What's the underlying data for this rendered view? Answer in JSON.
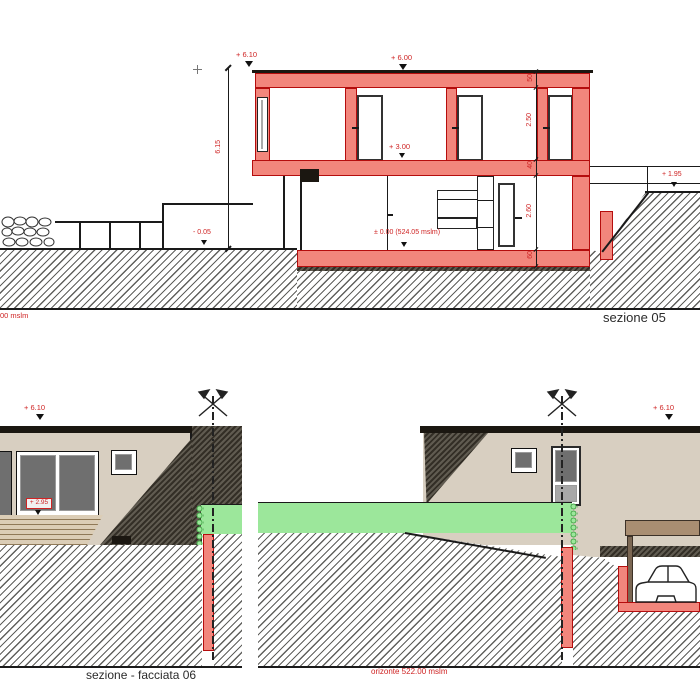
{
  "top_section": {
    "title": "sezione 05",
    "horizon_partial": "00 mslm",
    "labels": {
      "roof_left": "+ 6.10",
      "roof_right": "+ 6.00",
      "upper_floor": "+ 3.00",
      "zero": "± 0.00 (524.05 mslm)",
      "terrain_left": "- 0.05",
      "terrain_right": "+ 1.95"
    },
    "dims": {
      "total": "6.15",
      "roof_slab": "50",
      "upper_room": "2.50",
      "floor_slab": "40",
      "lower_room": "2.60",
      "base_slab": "60"
    }
  },
  "facade_left": {
    "title": "sezione - facciata 06",
    "labels": {
      "roof": "+ 6.10",
      "deck": "+ 2.95"
    }
  },
  "facade_right": {
    "labels": {
      "roof": "+ 6.10",
      "horizon": "orizonte 522.00 mslm"
    }
  },
  "colors": {
    "section_red": "#f2867c",
    "section_red_line": "#b50d0d",
    "label_red": "#cf2424",
    "facade_beige": "#d8cfc1",
    "grass_green": "#9ce79b",
    "carport_brown": "#a98e72"
  }
}
